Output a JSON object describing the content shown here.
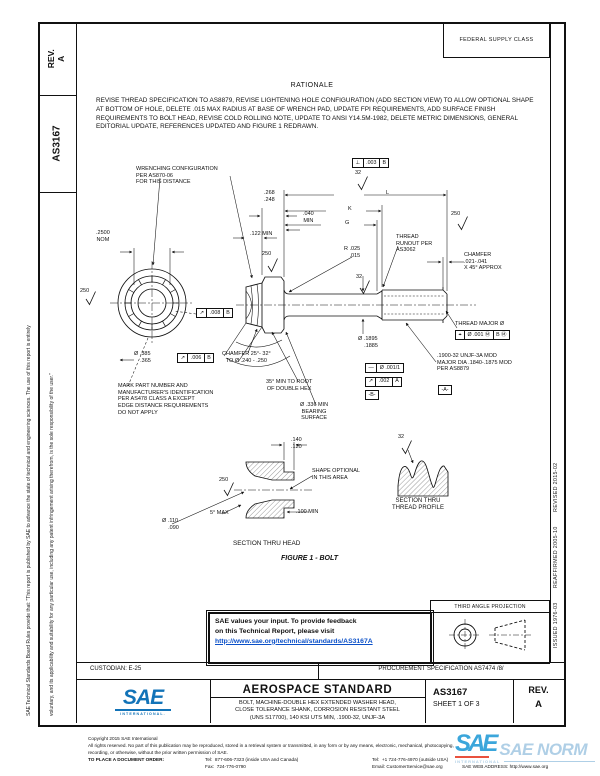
{
  "colors": {
    "ink": "#111111",
    "link_blue": "#0b50c8",
    "sae_logo_blue": "#1273b8",
    "watermark_blue": "#a9cbe4",
    "watermark_accent_red": "#e8432e"
  },
  "doc": {
    "fsc": "FEDERAL SUPPLY CLASS",
    "rev_label": "REV.",
    "rev_value": "A",
    "doc_number": "AS3167",
    "disclaimer_1": "SAE Technical Standards Board Rules provide that: \"This report is published by SAE to advance the state of technical and engineering sciences. The use of this report is entirely",
    "disclaimer_2": "voluntary, and its applicability and suitability for any particular use, including any patent infringement arising therefrom, is the sole responsibility of the user.\"",
    "history": "ISSUED 1976-03        REAFFIRMED 2005-10        REVISED 2015-02"
  },
  "rationale": {
    "title": "RATIONALE",
    "body": "REVISE THREAD SPECIFICATION TO AS8879, REVISE LIGHTENING HOLE CONFIGURATION (ADD SECTION VIEW) TO ALLOW OPTIONAL SHAPE AT BOTTOM OF HOLE, DELETE .015 MAX RADIUS AT BASE OF WRENCH PAD, UPDATE FPI REQUIREMENTS, ADD SURFACE FINISH REQUIREMENTS TO BOLT HEAD, REVISE COLD ROLLING NOTE, UPDATE TO ANSI Y14.5M-1982, DELETE METRIC DIMENSIONS, GENERAL EDITORIAL UPDATE, REFERENCES UPDATED AND FIGURE 1 REDRAWN."
  },
  "figure": {
    "caption": "FIGURE 1 - BOLT",
    "labels": {
      "wrenching_note": "WRENCHING CONFIGURATION\nPER AS870-06\nFOR THIS DISTANCE",
      "dim_2500": ".2500\nNOM",
      "finish_250_head": "250",
      "finish_250_flange": "250",
      "finish_250_shank": "250",
      "finish_250_section": "250",
      "finish_32_top": "32",
      "finish_32_shank": "32",
      "finish_32_profile": "32",
      "dim_L": "L",
      "dim_K": "K",
      "dim_G": "G",
      "dim_268": ".268\n.248",
      "dim_040": ".040\nMIN",
      "dim_122": ".122 MIN",
      "thread_runout": "THREAD\nRUNOUT PER\nAS3062",
      "radius": "R",
      "radius_val": ".025\n.015",
      "chamfer_right": "CHAMFER\n.021-.041\nX 45° APPROX",
      "thread_major": "THREAD MAJOR Ø",
      "dim_1895": "Ø .1895\n    .1885",
      "thread_spec": ".1900-32 UNJF-3A MOD\nMAJOR DIA .1840-.1875 MOD\nPER AS8879",
      "datum_a": "-A-",
      "datum_b": "-B-",
      "dim_385": "Ø .385\n    .365",
      "chamfer_left": "CHAMFER 25°- 32°\nTO Ø .240 - .250",
      "mark_note": "MARK PART NUMBER AND\nMANUFACTURER'S IDENTIFICATION\nPER AS478 CLASS A EXCEPT\nEDGE DISTANCE REQUIREMENTS\nDO NOT APPLY",
      "hex_note": "35° MIN TO ROOT\nOF DOUBLE HEX",
      "bearing_note": "Ø .336 MIN\nBEARING\nSURFACE",
      "dim_140": ".140\n.120",
      "shape_note": "SHAPE OPTIONAL\nIN THIS AREA",
      "deg5": "5° MAX",
      "dim_110": "Ø .110\n    .090",
      "dim_100": ".100 MIN",
      "section_head": "SECTION THRU HEAD",
      "section_profile": "SECTION THRU\nTHREAD PROFILE"
    },
    "fcf": {
      "perp": {
        "sym": "⊥",
        "val": ".003",
        "datum": "B"
      },
      "runout_008": {
        "sym": "↗",
        "val": ".008",
        "datum": "B"
      },
      "runout_006": {
        "sym": "↗",
        "val": ".006",
        "datum": "B"
      },
      "position": {
        "sym": "⌖",
        "val": "Ø .001 Ⓜ",
        "datum": "B Ⓜ"
      },
      "straight": {
        "sym": "—",
        "val": "Ø .001/1"
      },
      "runout_002": {
        "sym": "↗",
        "val": ".002",
        "datum": "A"
      }
    }
  },
  "feedback": {
    "line1": "SAE values your input. To provide feedback",
    "line2": "on this Technical Report, please visit",
    "link": "http://www.sae.org/technical/standards/AS3167A"
  },
  "projection": {
    "title": "THIRD ANGLE PROJECTION"
  },
  "title_block": {
    "custodian": "CUSTODIAN: E-25",
    "procurement": "PROCUREMENT SPECIFICATION AS7474 /8/",
    "standard": "AEROSPACE STANDARD",
    "subtitle": "BOLT, MACHINE-DOUBLE HEX EXTENDED WASHER HEAD,\nCLOSE TOLERANCE SHANK, CORROSION RESISTANT STEEL\n(UNS S17700), 140 KSI UTS MIN, .1900-32, UNJF-3A",
    "number": "AS3167",
    "sheet": "SHEET 1 OF 3",
    "rev_label": "REV.",
    "rev_value": "A",
    "logo_text": "SAE",
    "logo_sub": "INTERNATIONAL."
  },
  "footer": {
    "copyright": "Copyright 2015 SAE International",
    "rights1": "All rights reserved. No part of this publication may be reproduced, stored in a retrieval system or transmitted, in any form or by any means, electronic, mechanical, photocopying,",
    "rights2": "recording, or otherwise, without the prior written permission of SAE.",
    "order_label": "TO PLACE A DOCUMENT ORDER:",
    "tel_inside": "Tel:  877-606-7323 (inside USA and Canada)",
    "tel_outside": "Tel:  +1 724-776-4970 (outside USA)",
    "fax": "Fax:  724-776-0790",
    "email": "Email: CustomerService@sae.org",
    "web": "SAE WEB ADDRESS: http://www.sae.org"
  },
  "watermark": {
    "logo": "SAE",
    "text": "SAE NORM",
    "sub": "INTERNATIONAL"
  }
}
